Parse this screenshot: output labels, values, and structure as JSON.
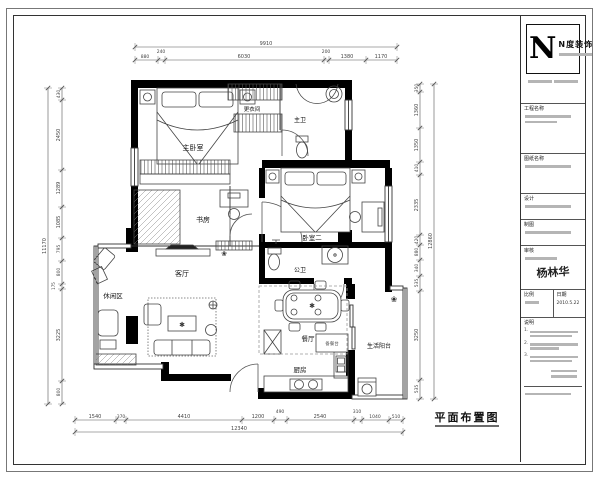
{
  "drawing_title": "平面布置图",
  "rooms": {
    "master_bedroom": "主卧室",
    "dressing_room": "更衣间",
    "master_bath": "主卫",
    "study": "书房",
    "bedroom_two": "卧室二",
    "public_bath": "公卫",
    "living_room": "客厅",
    "leisure_area": "休闲区",
    "dining_room": "餐厅",
    "kitchen": "厨房",
    "balcony": "生活阳台",
    "prep_counter": "备餐台"
  },
  "icons": {
    "plant": "❀",
    "star": "✱"
  },
  "dims": {
    "top_total": "9910",
    "top": [
      "880",
      "240",
      "6030",
      "200",
      "1380",
      "1170"
    ],
    "bottom_total": "12340",
    "bottom": [
      "1540",
      "370",
      "4410",
      "1200",
      "490",
      "2540",
      "310",
      "1040",
      "510"
    ],
    "left_total": "11170",
    "left": [
      "430",
      "2450",
      "1289",
      "1085",
      "795",
      "800",
      "175",
      "3225",
      "800"
    ],
    "right_total": "12860",
    "right": [
      "350",
      "1360",
      "1350",
      "410",
      "2335",
      "420",
      "880",
      "340",
      "535",
      "3250",
      "535"
    ]
  },
  "title_block": {
    "logo_letter": "N",
    "logo_name": "N度装饰",
    "labels": {
      "project": "工程名称",
      "drawing": "图纸名称",
      "designer": "设计",
      "drafter": "制图",
      "checker": "审核",
      "scale": "比例",
      "date": "日期",
      "notes": "说明"
    },
    "signature": "杨林华",
    "date_value": "2010.5.22",
    "note_numbers": [
      "1.",
      "2.",
      "3."
    ]
  }
}
